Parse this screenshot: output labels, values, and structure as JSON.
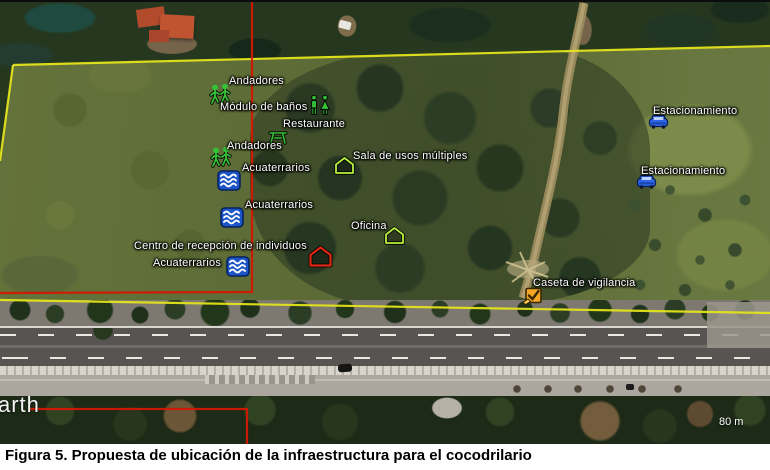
{
  "figure_caption": "Figura 5. Propuesta de ubicación de la infraestructura para el cocodrilario",
  "map": {
    "watermark_text": "arth",
    "scale_text": "80 m",
    "placemarks": [
      {
        "label": "Andadores",
        "icon": "hikers-icon"
      },
      {
        "label": "Módulo de baños",
        "icon": "restroom-icon"
      },
      {
        "label": "Restaurante",
        "icon": "picnic-table-icon"
      },
      {
        "label": "Andadores",
        "icon": "hikers-icon"
      },
      {
        "label": "Acuaterrarios",
        "icon": "waves-icon"
      },
      {
        "label": "Acuaterrarios",
        "icon": "waves-icon"
      },
      {
        "label": "Sala de usos múltiples",
        "icon": "home-icon"
      },
      {
        "label": "Oficina",
        "icon": "home-icon"
      },
      {
        "label": "Centro de recepción de individuos",
        "icon": "home-icon"
      },
      {
        "label": "Acuaterrarios",
        "icon": "waves-icon"
      },
      {
        "label": "Estacionamiento",
        "icon": "car-icon"
      },
      {
        "label": "Estacionamiento",
        "icon": "car-icon"
      },
      {
        "label": "Caseta de vigilancia",
        "icon": "tools-icon"
      }
    ],
    "boundary_colors": {
      "site_polygon": "#e4e41c",
      "reference_lines": "#d41800"
    },
    "icon_colors": {
      "green_markers": "#35c135",
      "blue_markers": "#1d55c8",
      "orange_marker": "#f5a623",
      "red_home_outline": "#e02812",
      "green_home_outline": "#b8f33c"
    }
  }
}
